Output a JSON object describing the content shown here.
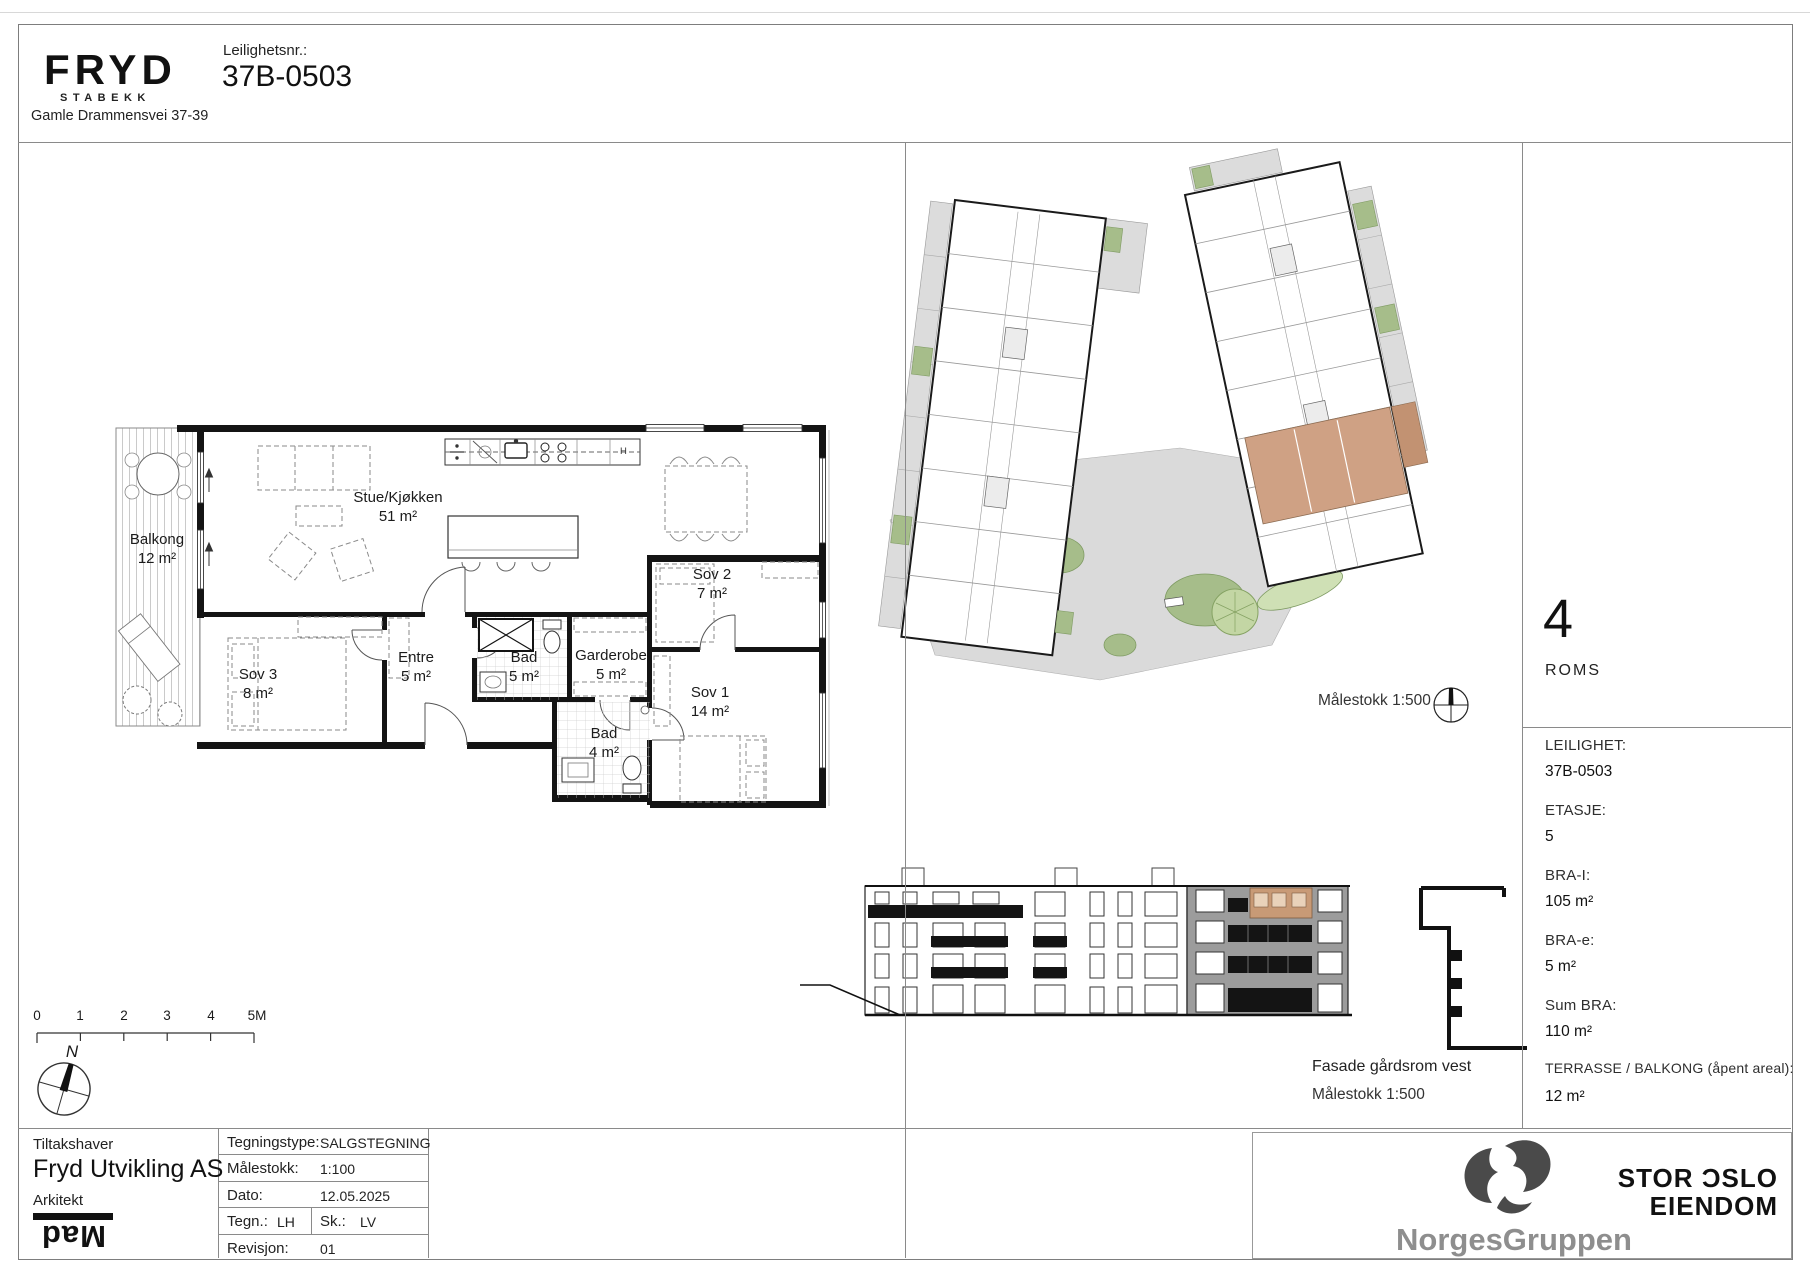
{
  "header": {
    "brand": "FRYD",
    "brand_sub": "STABEKK",
    "address": "Gamle Drammensvei 37-39",
    "apartment_no_label": "Leilighetsnr.:",
    "apartment_no": "37B-0503"
  },
  "floorplan": {
    "rooms": [
      {
        "name": "Balkong",
        "area": "12 m²"
      },
      {
        "name": "Stue/Kjøkken",
        "area": "51 m²"
      },
      {
        "name": "Sov 2",
        "area": "7 m²"
      },
      {
        "name": "Sov 3",
        "area": "8 m²"
      },
      {
        "name": "Entre",
        "area": "5 m²"
      },
      {
        "name": "Bad",
        "area": "5 m²"
      },
      {
        "name": "Garderobe",
        "area": "5 m²"
      },
      {
        "name": "Sov 1",
        "area": "14 m²"
      },
      {
        "name": "Bad",
        "area": "4 m²"
      }
    ],
    "kitchen_hood_label": "H",
    "north_label": "N",
    "scalebar_labels": [
      "0",
      "1",
      "2",
      "3",
      "4",
      "5M"
    ]
  },
  "siteplan": {
    "scale_label": "Målestokk 1:500"
  },
  "facade": {
    "caption": "Fasade gårdsrom vest",
    "scale_label": "Målestokk 1:500"
  },
  "sidebar": {
    "rooms_count": "4",
    "rooms_label": "ROMS",
    "details": [
      {
        "label": "LEILIGHET:",
        "value": "37B-0503"
      },
      {
        "label": "ETASJE:",
        "value": "5"
      },
      {
        "label": "BRA-I:",
        "value": "105 m²"
      },
      {
        "label": "BRA-e:",
        "value": "5 m²"
      },
      {
        "label": "Sum BRA:",
        "value": "110 m²"
      },
      {
        "label": "TERRASSE / BALKONG (åpent areal):",
        "value": "12 m²"
      }
    ]
  },
  "titleblock": {
    "owner_label": "Tiltakshaver",
    "owner": "Fryd Utvikling AS",
    "architect_label": "Arkitekt",
    "architect": "Mad",
    "rows": [
      {
        "label": "Tegningstype:",
        "value": "SALGSTEGNING"
      },
      {
        "label": "Målestokk:",
        "value": "1:100"
      },
      {
        "label": "Dato:",
        "value": "12.05.2025"
      },
      {
        "label": "Tegn.:",
        "value": "LH",
        "label2": "Sk.:",
        "value2": "LV"
      },
      {
        "label": "Revisjon:",
        "value": "01"
      }
    ]
  },
  "footer": {
    "norgesgruppen": "NorgesGruppen",
    "storoslo_line1": "STOR ƆSLO",
    "storoslo_line2": "EIENDOM"
  },
  "colors": {
    "highlight_unit": "#cfa184",
    "wall": "#141414",
    "green": "#a6bd8a",
    "terrace_gray": "#dcdcdc",
    "facade_gray": "#9c9c9c"
  }
}
